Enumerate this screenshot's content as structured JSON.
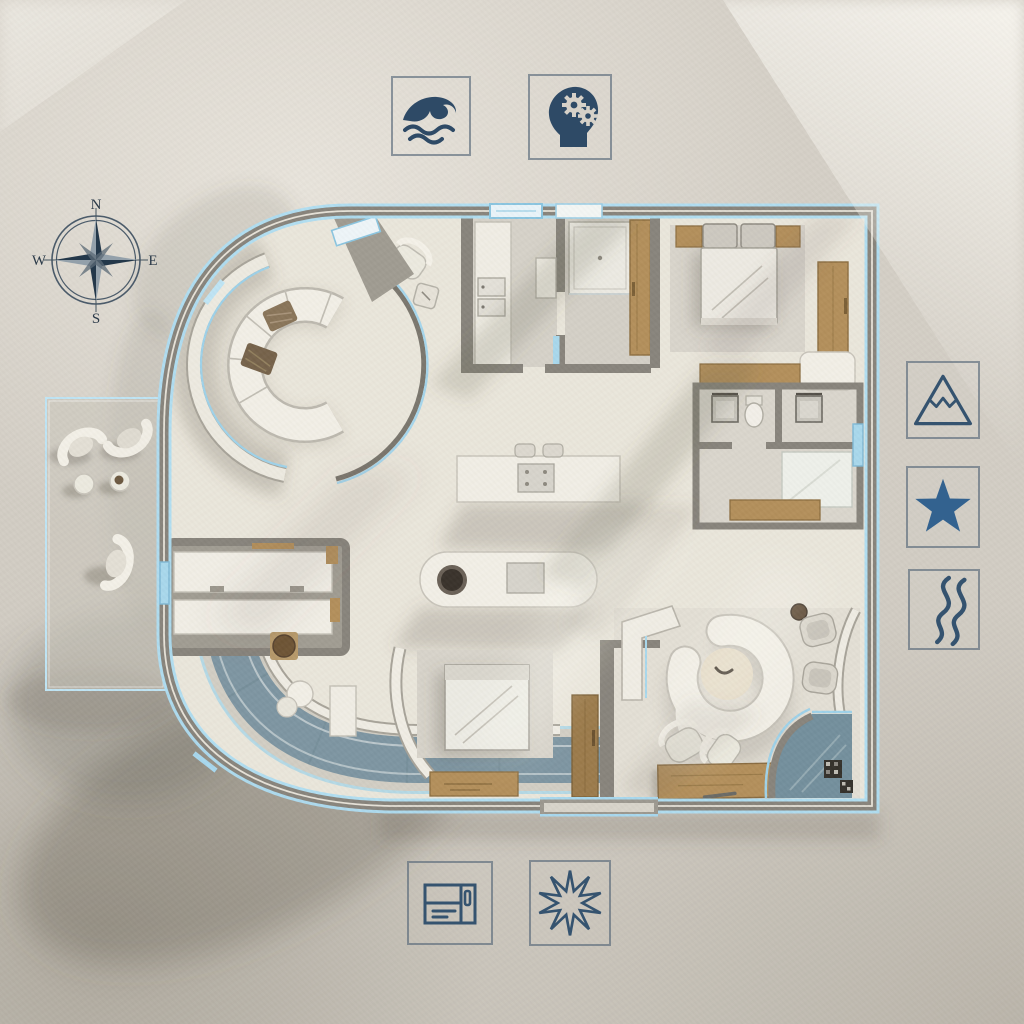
{
  "compass": {
    "north": "N",
    "east": "E",
    "south": "S",
    "west": "W"
  },
  "icons": {
    "top": [
      "ocean-wave",
      "head-with-gears"
    ],
    "right": [
      "mountain-peak",
      "five-point-star",
      "winding-river"
    ],
    "bottom": [
      "cabinet-layout",
      "starburst"
    ]
  },
  "palette": {
    "background": "#d3cec5",
    "walls": "#89857c",
    "floor": "#edeadf",
    "neon_blue": "#a8d8ee",
    "water": "#7e96a2",
    "wood": "#b3905c",
    "icon_navy": "#2e4a66",
    "star_blue": "#33628f",
    "compass_ink": "#2c3a4a"
  }
}
